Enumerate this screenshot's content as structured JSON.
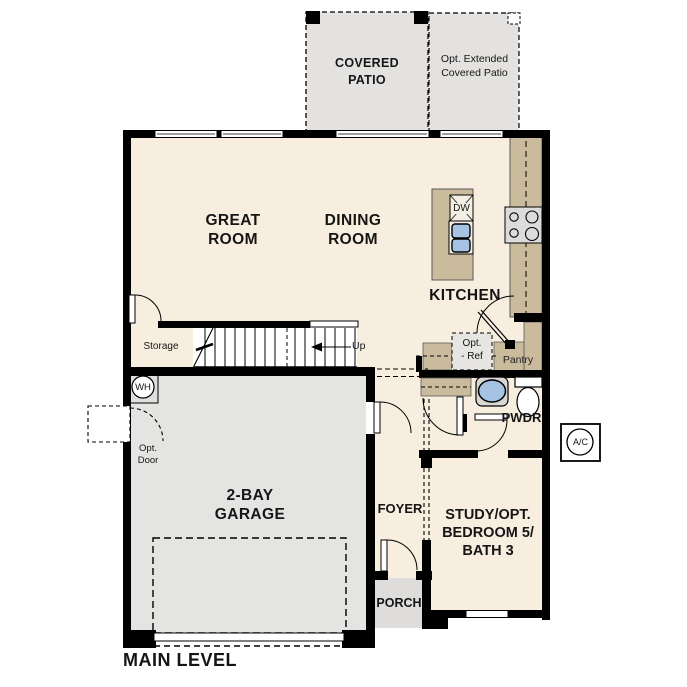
{
  "floor_plan": {
    "title": "MAIN LEVEL",
    "rooms": {
      "great_room": {
        "line1": "GREAT",
        "line2": "ROOM"
      },
      "dining_room": {
        "line1": "DINING",
        "line2": "ROOM"
      },
      "kitchen": "KITCHEN",
      "garage": {
        "line1": "2-BAY",
        "line2": "GARAGE"
      },
      "foyer": "FOYER",
      "powder": "PWDR",
      "study": {
        "line1": "STUDY/OPT.",
        "line2": "BEDROOM 5/",
        "line3": "BATH 3"
      },
      "storage": "Storage",
      "pantry": "Pantry"
    },
    "outdoor": {
      "covered_patio": {
        "line1": "COVERED",
        "line2": "PATIO"
      },
      "optional_extended_patio": {
        "line1": "Opt. Extended",
        "line2": "Covered Patio"
      },
      "porch": "PORCH"
    },
    "annotations": {
      "stairs_up": "Up",
      "optional_door": {
        "line1": "Opt.",
        "line2": "Door"
      },
      "optional_refrigerator": {
        "line1": "Opt.",
        "line2": "- Ref"
      },
      "dishwasher": "DW",
      "water_heater": "WH",
      "ac_unit": "A/C"
    },
    "colors": {
      "floor_cream": "#f7eee0",
      "patio_gray": "#e3e2e0",
      "garage_gray": "#e4e4e2",
      "porch_gray": "#dedddb",
      "cabinet_tan": "#cbbb9d",
      "fixture_blue": "#a6c3e3",
      "wall_black": "#000000"
    }
  }
}
